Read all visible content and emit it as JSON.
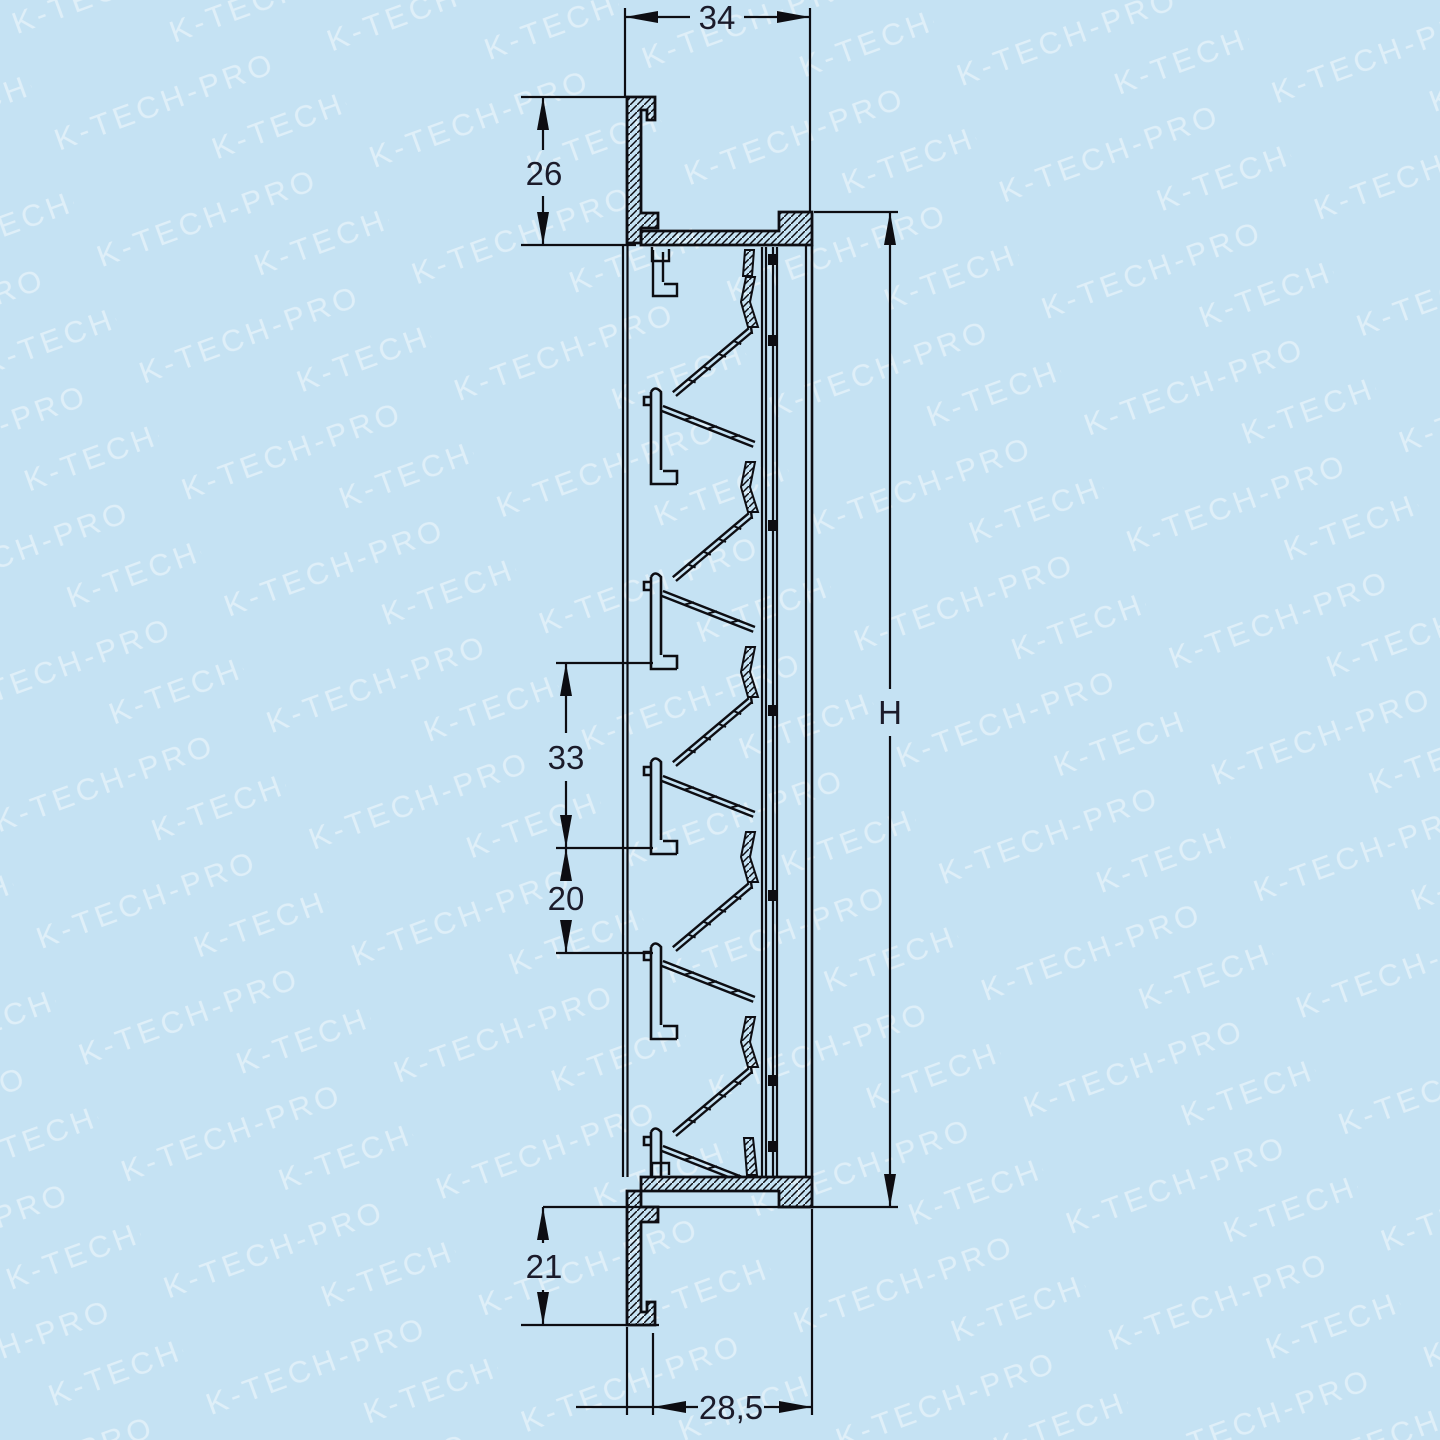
{
  "page": {
    "background_color": "#c5e2f3",
    "line_color": "#0d0d12",
    "dimension_text_color": "#1b1b2a"
  },
  "watermark": {
    "text": "K-TECH-PRO"
  },
  "drawing": {
    "type": "technical-cross-section",
    "subject": "ventilation louvre grille profile, side section view",
    "dimensions": {
      "top_width": "34",
      "upper_frame_depth": "26",
      "slat_pitch": "33",
      "slat_gap": "20",
      "overall_height": "H",
      "lower_frame_depth": "21",
      "bottom_width": "28,5"
    }
  }
}
